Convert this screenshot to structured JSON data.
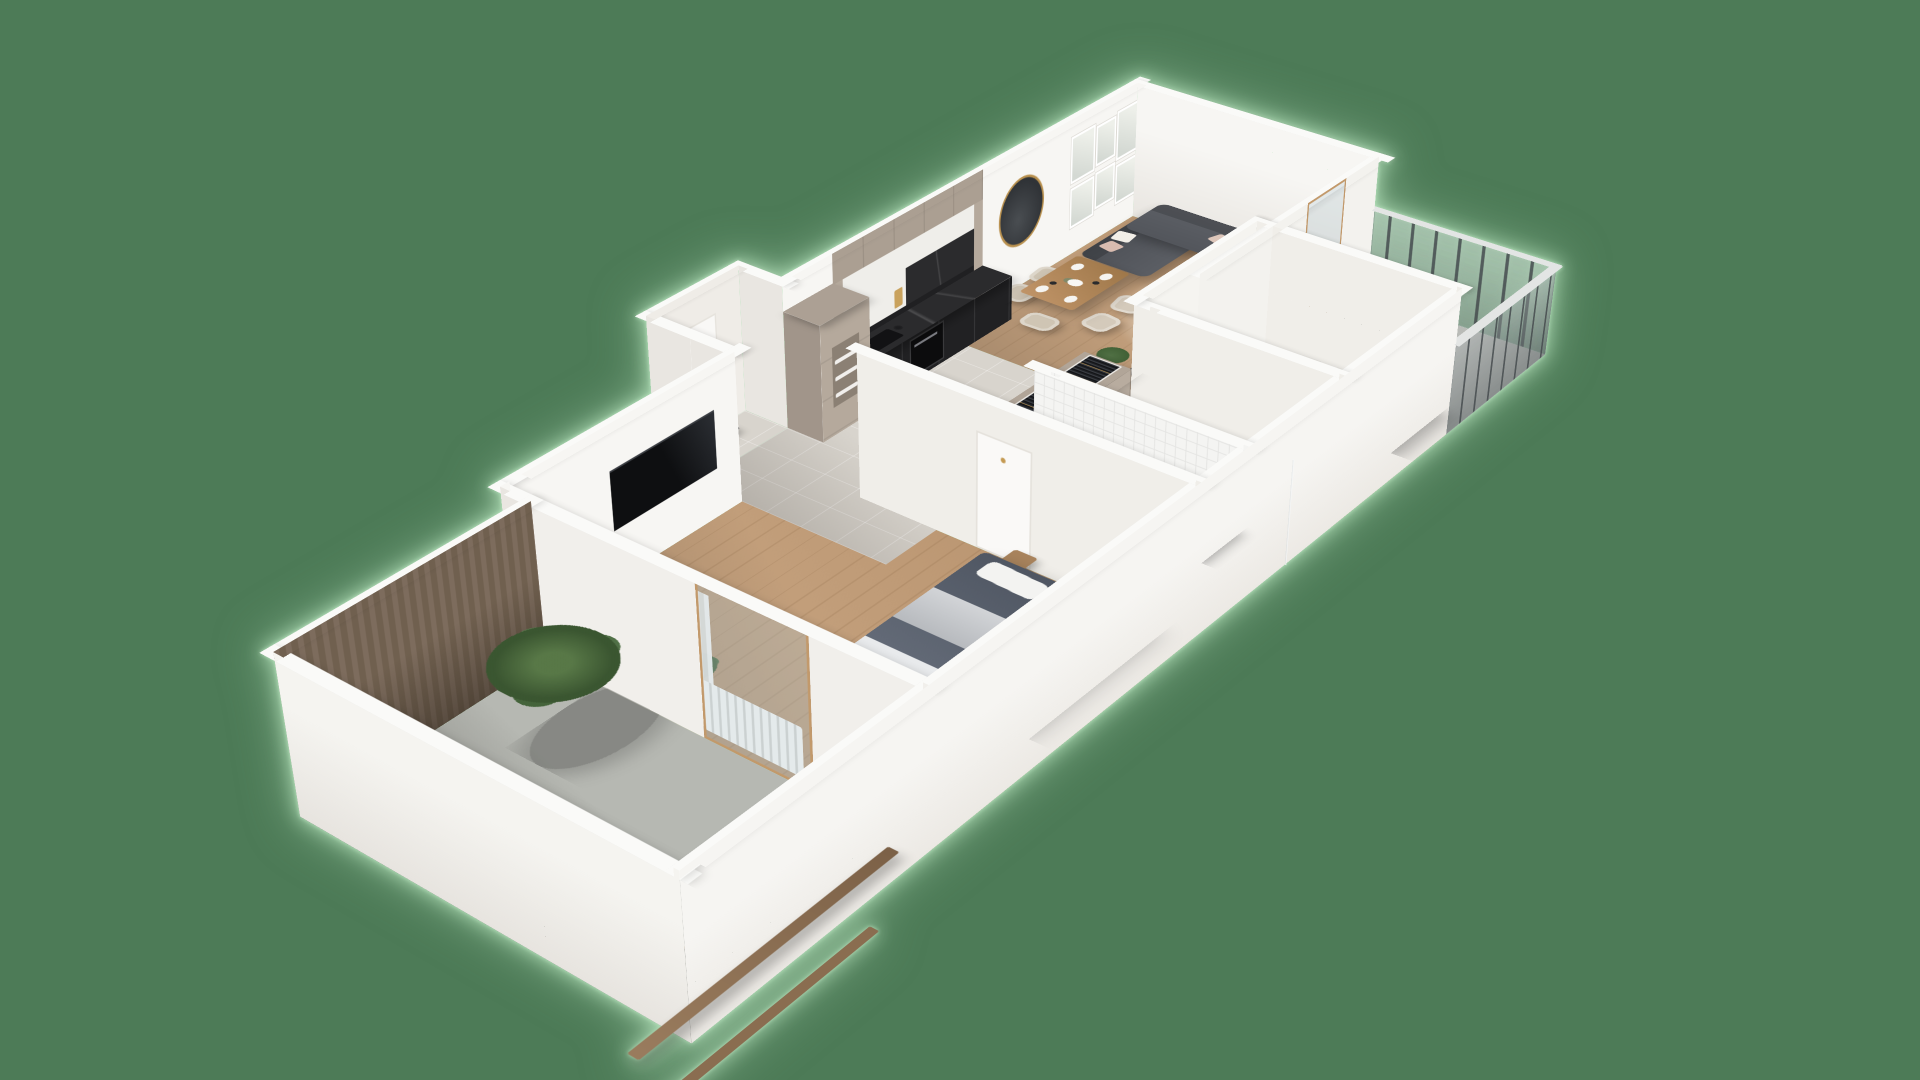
{
  "scene": {
    "type": "3d-apartment-floor-plan-render",
    "view": "isometric bird's-eye",
    "background_color": "#4d7b57",
    "halo_color": "#bae6c0"
  },
  "palette": {
    "wall": "#f7f6f3",
    "wall_outer": "#f1efeb",
    "wall_side": "#e9e6e1",
    "wood_floor": "#c49d76",
    "tile_floor": "#d8d4cd",
    "marble_floor": "#edebe7",
    "concrete_floor": "#b6b8b2",
    "cabinet_taupe": "#b5a99c",
    "counter_dark": "#2b2b2d",
    "sofa_gray": "#54575d",
    "bed_blue_gray": "#59616f",
    "blanket_green": "#7a8e6f",
    "accent_wood": "#75655a",
    "plant_green": "#41603a",
    "brass": "#c49a52",
    "railing_gray": "#8e9698"
  },
  "rooms": [
    {
      "id": "living-room",
      "label": "Living room",
      "furniture": [
        "corner sofa with pillows",
        "dining table with place settings",
        "four dining chairs",
        "round coffee tables",
        "dark tv sideboard",
        "round wall mirror",
        "gallery picture frames",
        "area rug"
      ]
    },
    {
      "id": "kitchen",
      "label": "Kitchen",
      "furniture": [
        "taupe cabinet wall",
        "dark marble countertop",
        "sink and faucet",
        "oven",
        "tall shelf cabinet with dishes"
      ]
    },
    {
      "id": "entry",
      "label": "Entry hall",
      "furniture": [
        "entrance door",
        "black bench"
      ]
    },
    {
      "id": "corridor",
      "label": "Corridor wardrobe",
      "furniture": [
        "open-top wardrobe with hanging clothes"
      ]
    },
    {
      "id": "bedroom-small",
      "label": "Small bedroom",
      "furniture": [
        "bed with green blanket",
        "round fluffy rug",
        "beige lounge chair",
        "sheer curtain"
      ]
    },
    {
      "id": "bathroom",
      "label": "Bathroom",
      "furniture": [
        "washing machine",
        "toilet",
        "bidet",
        "glass shower screen",
        "tiled walls"
      ]
    },
    {
      "id": "master-bedroom",
      "label": "Master bedroom",
      "furniture": [
        "double bed with blue-gray duvet",
        "wall tv",
        "radiator",
        "open closet with clothes",
        "glass terrace door",
        "white curtains"
      ]
    },
    {
      "id": "terrace",
      "label": "Terrace",
      "furniture": [
        "outdoor bench",
        "palm plant",
        "dark wood accent wall",
        "wood railing beams"
      ]
    },
    {
      "id": "balcony",
      "label": "Balcony",
      "furniture": [
        "hanging egg chair",
        "potted tree",
        "glass-metal railing"
      ]
    }
  ]
}
